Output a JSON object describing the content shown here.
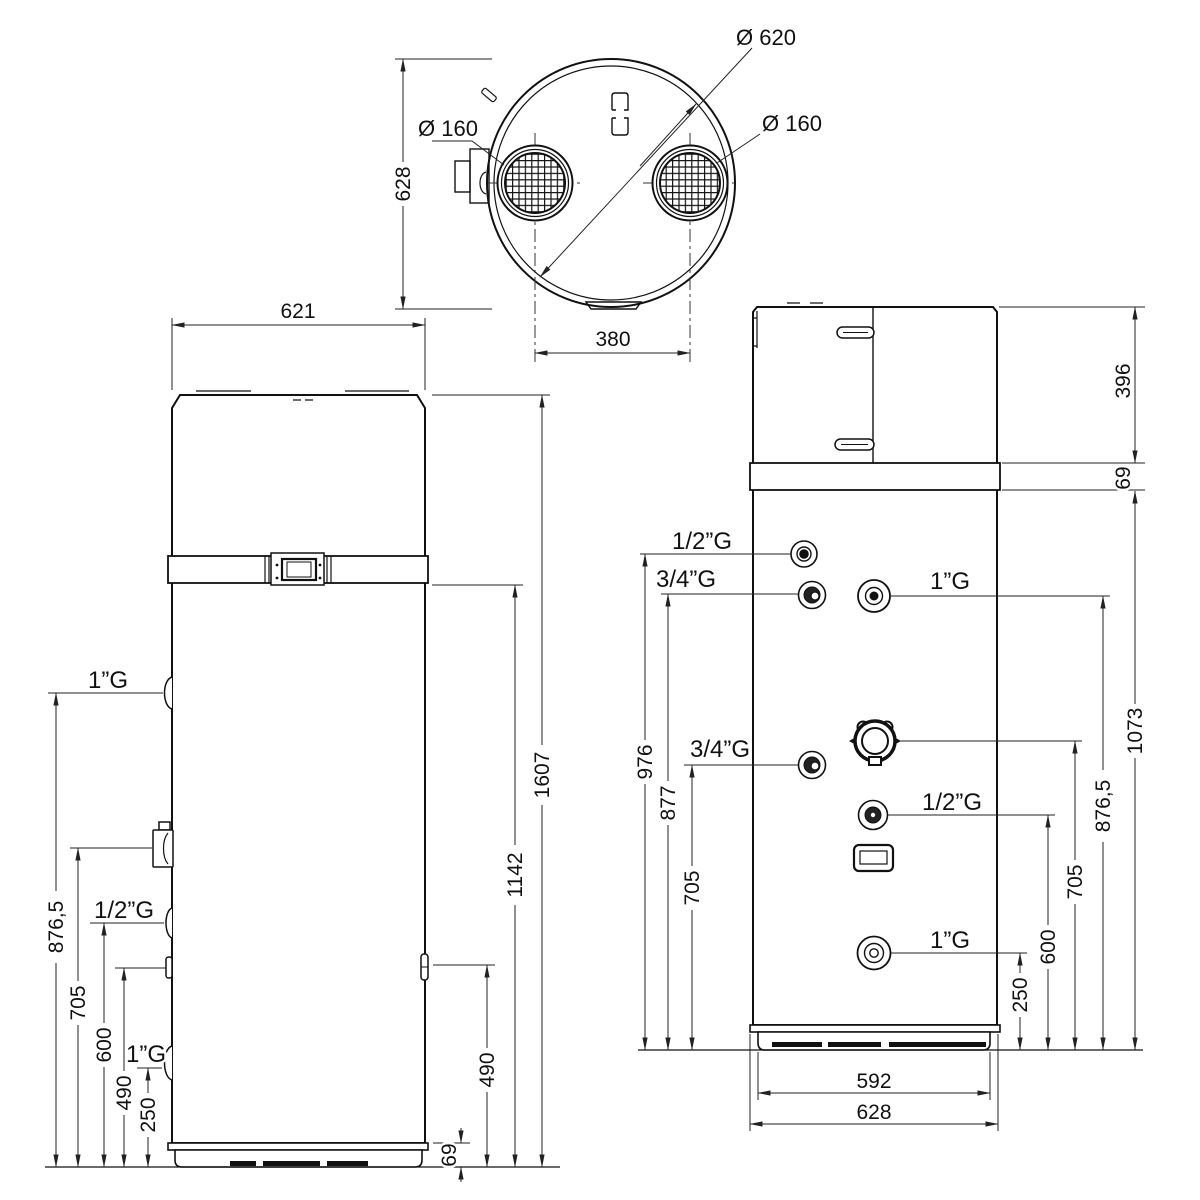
{
  "colors": {
    "line": "#111111",
    "background": "#ffffff"
  },
  "top_view": {
    "dim_628": "628",
    "dim_380": "380",
    "label_outer_diameter": "Ø 620",
    "label_duct_left": "Ø 160",
    "label_duct_right": "Ø 160"
  },
  "front_view": {
    "dim_width": "621",
    "dim_total_height": "1607",
    "dim_band_height": "1142",
    "dim_right_fitting": "490",
    "dim_base": "69",
    "dims_left": {
      "p876": "876,5",
      "p705": "705",
      "p600": "600",
      "p490": "490",
      "p250": "250"
    },
    "labels": {
      "port_top": "1”G",
      "port_mid": "1/2”G",
      "port_low": "1”G"
    }
  },
  "back_view": {
    "dim_cap": "396",
    "dim_band": "69",
    "dim_body": "1073",
    "dims_left": {
      "p976": "976",
      "p877": "877",
      "p705": "705"
    },
    "dims_right": {
      "p876": "876,5",
      "p705": "705",
      "p600": "600",
      "p250": "250"
    },
    "dim_skirt_width": "592",
    "dim_width": "628",
    "labels": {
      "t_half": "1/2”G",
      "t_threeq": "3/4”G",
      "t_one": "1”G",
      "m_threeq": "3/4”G",
      "m_half": "1/2”G",
      "b_one": "1”G"
    }
  }
}
